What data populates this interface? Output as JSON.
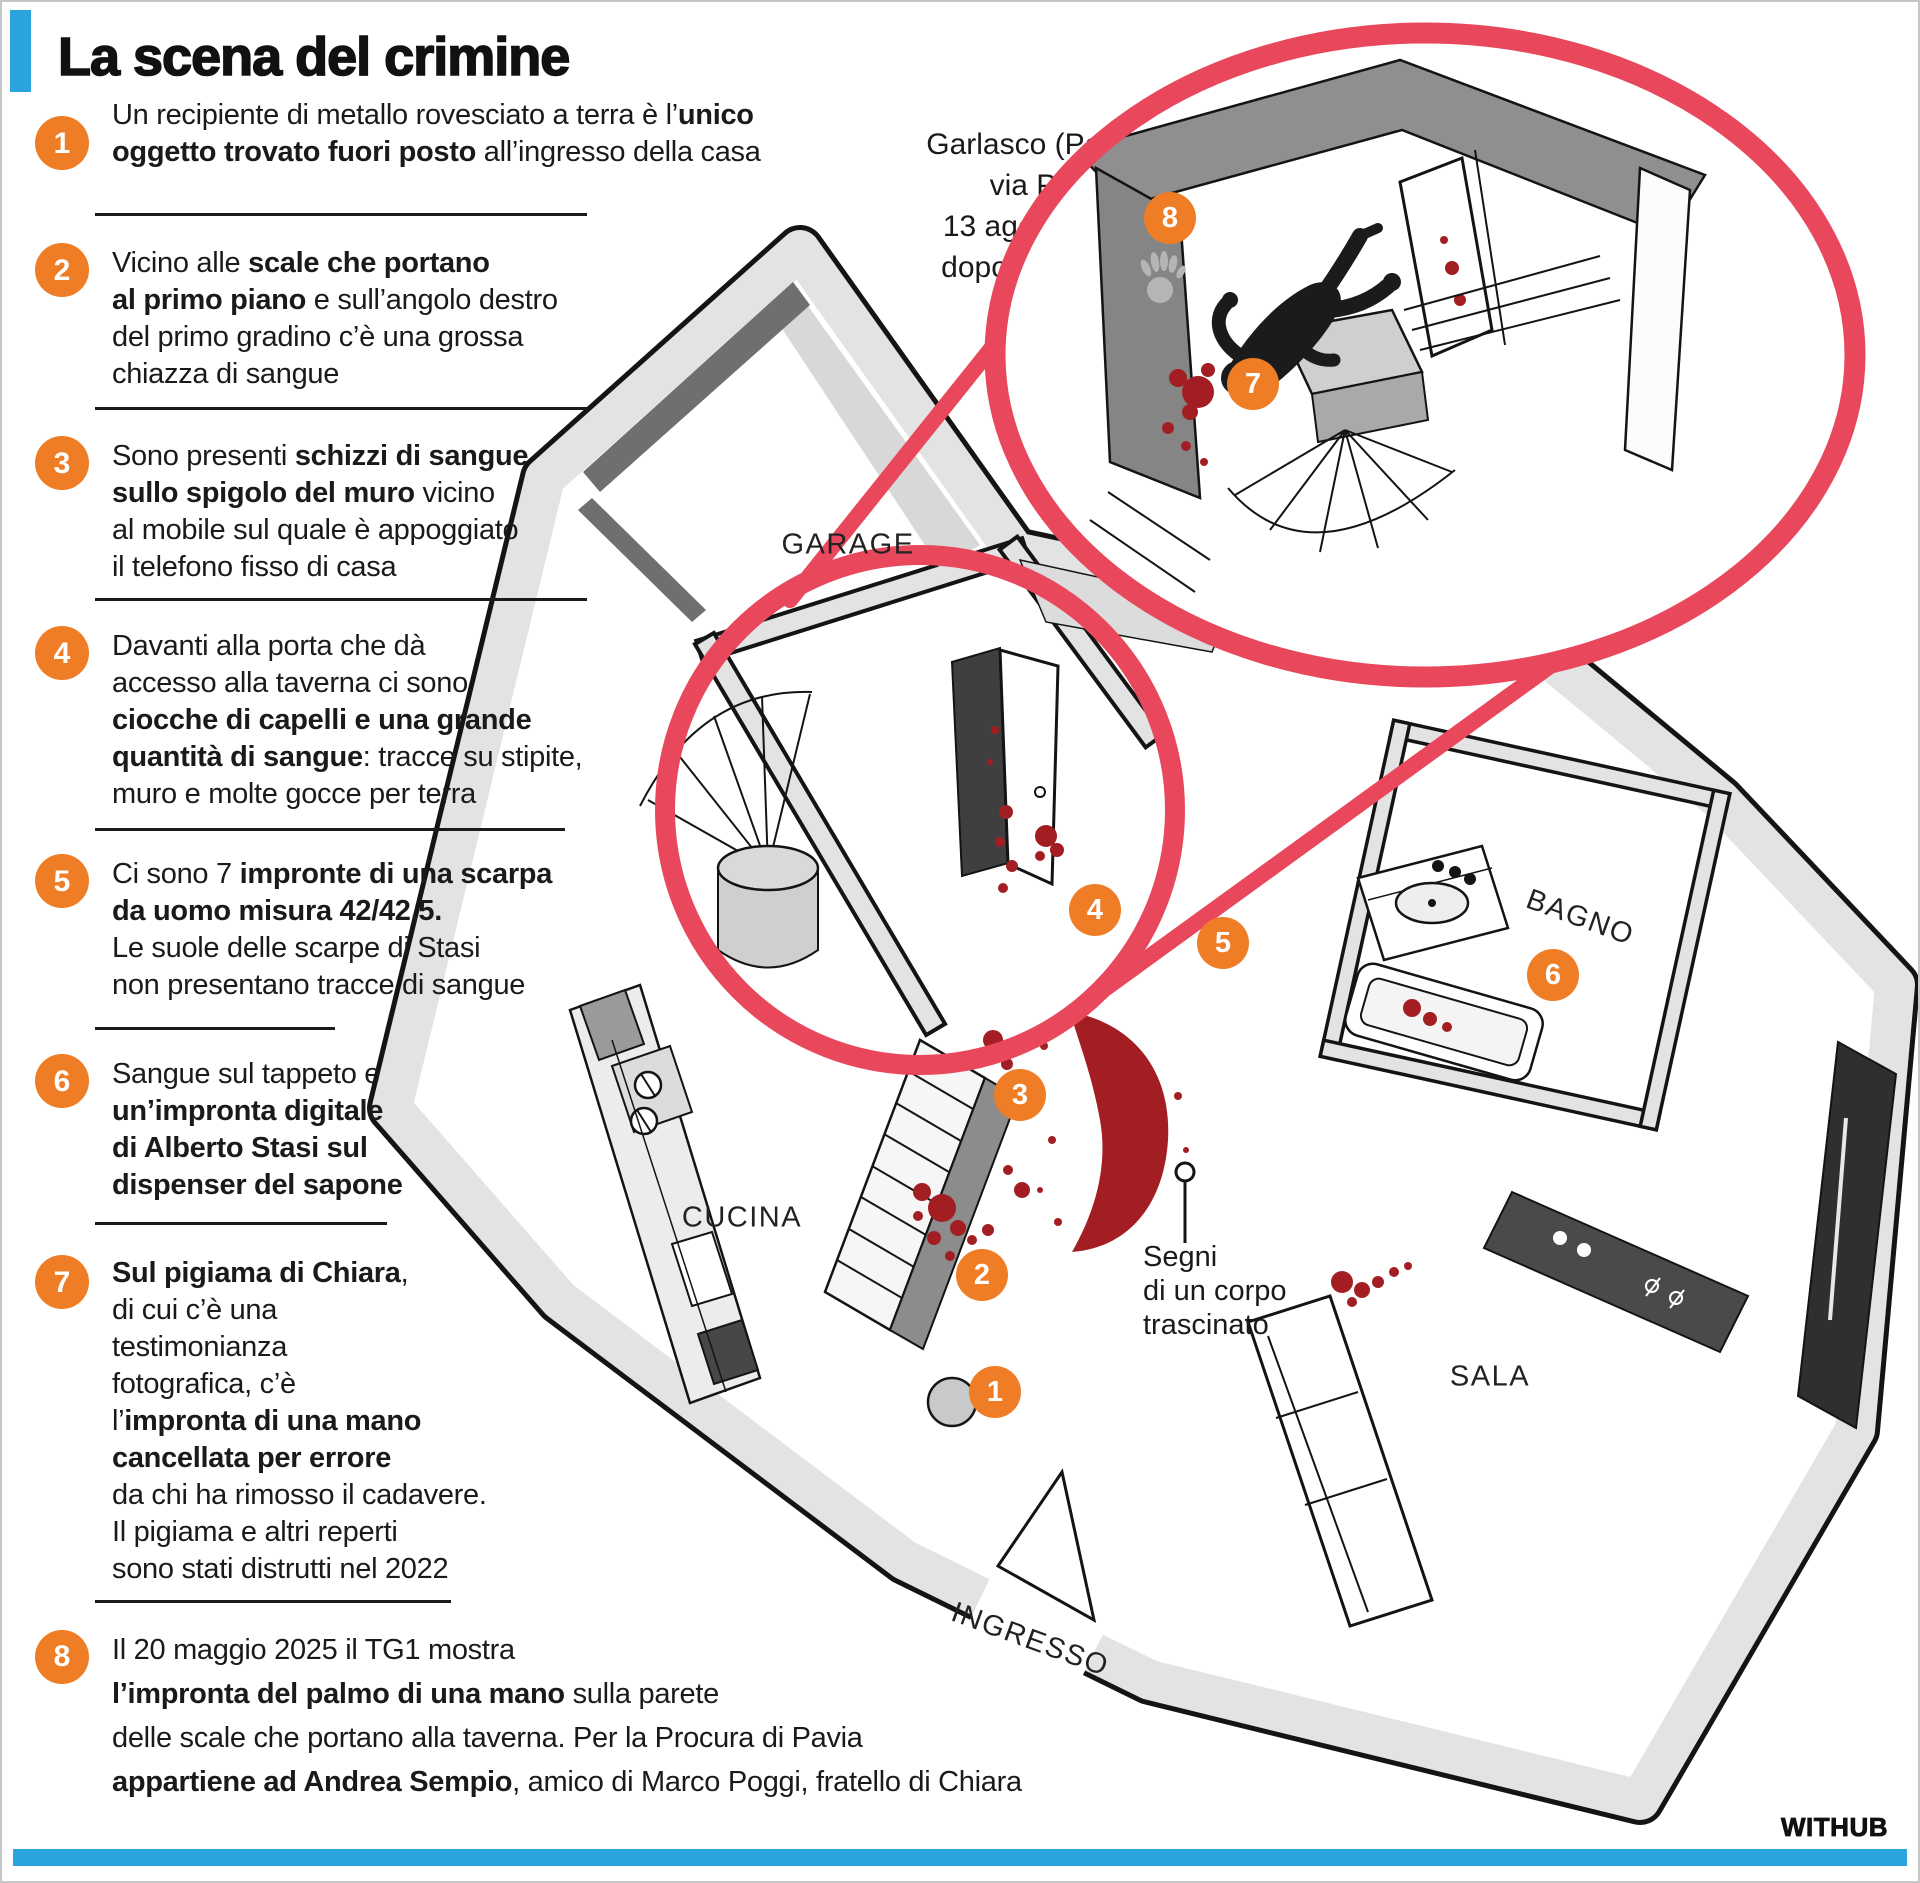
{
  "title": "La scena del crimine",
  "location": {
    "lines": [
      "Garlasco (Pavia),",
      "via Pascoli 8",
      "13 agosto 2007,",
      "dopo le ore 9:12"
    ]
  },
  "items": [
    {
      "num": "1",
      "lines": [
        [
          {
            "t": "Un recipiente di metallo rovesciato a terra è l’"
          },
          {
            "t": "unico",
            "b": 1
          }
        ],
        [
          {
            "t": "oggetto trovato fuori posto",
            "b": 1
          },
          {
            "t": " all’ingresso della casa"
          }
        ]
      ]
    },
    {
      "num": "2",
      "lines": [
        [
          {
            "t": "Vicino alle "
          },
          {
            "t": "scale che portano",
            "b": 1
          }
        ],
        [
          {
            "t": "al primo piano",
            "b": 1
          },
          {
            "t": " e sull’angolo destro"
          }
        ],
        [
          {
            "t": "del primo gradino c’è una grossa"
          }
        ],
        [
          {
            "t": "chiazza di sangue"
          }
        ]
      ]
    },
    {
      "num": "3",
      "lines": [
        [
          {
            "t": "Sono presenti "
          },
          {
            "t": "schizzi di sangue",
            "b": 1
          }
        ],
        [
          {
            "t": "sullo spigolo del muro",
            "b": 1
          },
          {
            "t": " vicino"
          }
        ],
        [
          {
            "t": "al mobile sul quale è appoggiato"
          }
        ],
        [
          {
            "t": "il telefono fisso di casa"
          }
        ]
      ]
    },
    {
      "num": "4",
      "lines": [
        [
          {
            "t": "Davanti alla porta che dà"
          }
        ],
        [
          {
            "t": "accesso alla taverna ci sono"
          }
        ],
        [
          {
            "t": "ciocche di capelli e una grande",
            "b": 1
          }
        ],
        [
          {
            "t": "quantità di sangue",
            "b": 1
          },
          {
            "t": ": tracce su stipite,"
          }
        ],
        [
          {
            "t": "muro e molte gocce per terra"
          }
        ]
      ]
    },
    {
      "num": "5",
      "lines": [
        [
          {
            "t": "Ci sono 7 "
          },
          {
            "t": "impronte di una scarpa",
            "b": 1
          }
        ],
        [
          {
            "t": "da uomo misura 42/42,5.",
            "b": 1
          }
        ],
        [
          {
            "t": "Le suole delle scarpe di Stasi"
          }
        ],
        [
          {
            "t": "non presentano tracce di sangue"
          }
        ]
      ]
    },
    {
      "num": "6",
      "lines": [
        [
          {
            "t": "Sangue sul tappeto e"
          }
        ],
        [
          {
            "t": "un’impronta digitale",
            "b": 1
          }
        ],
        [
          {
            "t": "di Alberto Stasi sul",
            "b": 1
          }
        ],
        [
          {
            "t": "dispenser del sapone",
            "b": 1
          }
        ]
      ]
    },
    {
      "num": "7",
      "lines": [
        [
          {
            "t": "Sul pigiama di Chiara",
            "b": 1
          },
          {
            "t": ","
          }
        ],
        [
          {
            "t": "di cui c’è una"
          }
        ],
        [
          {
            "t": "testimonianza"
          }
        ],
        [
          {
            "t": "fotografica, c’è"
          }
        ],
        [
          {
            "t": "l’"
          },
          {
            "t": "impronta di una mano",
            "b": 1
          }
        ],
        [
          {
            "t": "cancellata per errore",
            "b": 1
          }
        ],
        [
          {
            "t": "da chi ha rimosso il cadavere."
          }
        ],
        [
          {
            "t": "Il pigiama e altri reperti"
          }
        ],
        [
          {
            "t": "sono stati distrutti nel 2022"
          }
        ]
      ]
    },
    {
      "num": "8",
      "lines": [
        [
          {
            "t": "Il 20 maggio 2025 il TG1 mostra"
          }
        ],
        [
          {
            "t": "l’impronta del palmo di una mano",
            "b": 1
          },
          {
            "t": "  sulla parete"
          }
        ],
        [
          {
            "t": "delle scale che portano  alla taverna. Per la Procura di Pavia"
          }
        ],
        [
          {
            "t": "appartiene ad Andrea Sempio",
            "b": 1
          },
          {
            "t": ", amico  di Marco Poggi, fratello di Chiara"
          }
        ]
      ]
    }
  ],
  "plan": {
    "rooms": {
      "garage": "GARAGE",
      "cucina": "CUCINA",
      "bagno": "BAGNO",
      "sala": "SALA",
      "ingresso": "INGRESSO"
    },
    "markers": [
      "1",
      "2",
      "3",
      "4",
      "5",
      "6",
      "7",
      "8"
    ],
    "callout": {
      "lines": [
        "Segni",
        "di un corpo",
        "trascinato"
      ]
    }
  },
  "footer": {
    "brand": "WITHUB"
  },
  "colors": {
    "accent_blue": "#2BA3DC",
    "marker_orange": "#EE7D26",
    "magnifier_red": "#E8475C",
    "blood_red": "#A31E22"
  }
}
